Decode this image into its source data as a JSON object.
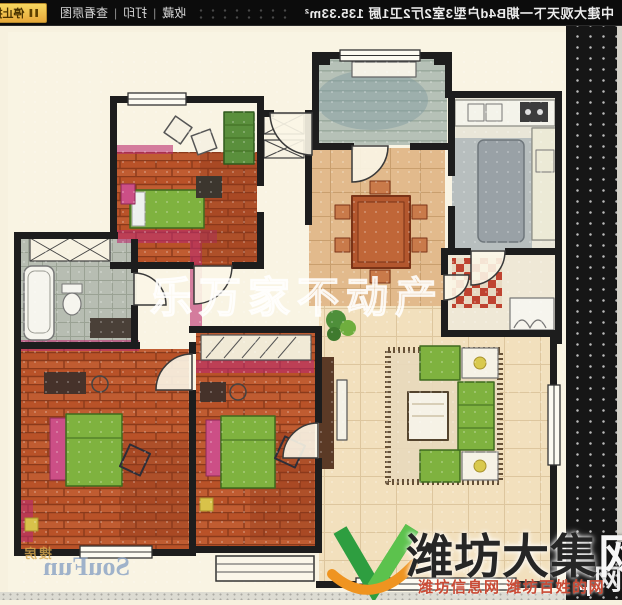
{
  "topbar": {
    "title": "中建大观天下一期B4d户型3室2厅2卫1厨 135.33m²",
    "links": [
      {
        "label": "收藏"
      },
      {
        "label": "打印"
      },
      {
        "label": "查看原图"
      }
    ],
    "separator": "|",
    "stop_button": {
      "icon": "pause-icon",
      "icon_glyph": "❚❚",
      "label": "停止播放"
    },
    "autoplay": {
      "options": [
        {
          "label": "20秒",
          "selected": true
        },
        {
          "label": "30秒",
          "selected": false
        }
      ]
    }
  },
  "watermarks": {
    "center": "乐万家不动产",
    "soufun": {
      "en": "SouFun",
      "cn": "搜房"
    },
    "daji": {
      "main_dark": "潍坊大集",
      "main_light": "网",
      "sub": "潍坊信息网 潍坊百姓的网",
      "strip_glyph": "网"
    }
  },
  "colors": {
    "topbar_bg": "#0c0c0c",
    "button_yellow": "#f0c94c",
    "paper_cream": "#f8f2e1",
    "wall_black": "#1d1d1d",
    "brick_red": "#c05c31",
    "furniture_green": "#7fb23f",
    "accent_pink": "#c2407a",
    "balcony_gray_green": "#b6c1b7",
    "wood_tan": "#e2ba8c",
    "daji_red": "#c94a35",
    "strip_black": "#161616"
  }
}
